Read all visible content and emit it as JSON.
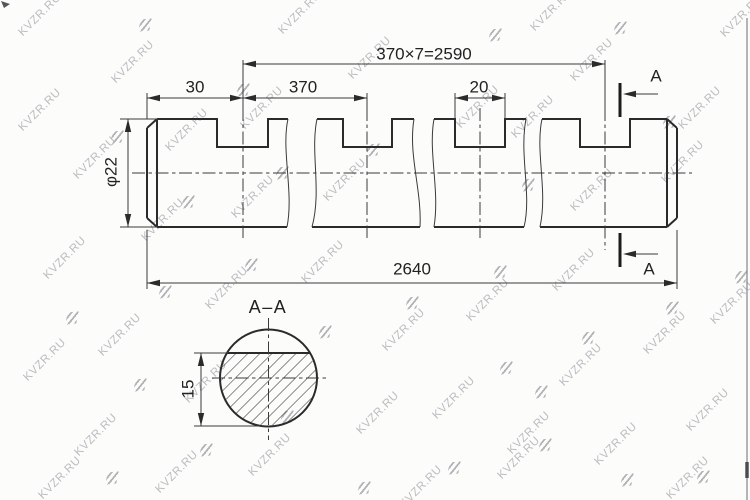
{
  "page": {
    "background": "#fcfcfb",
    "line_color": "#2b2b2b",
    "frame_edge_color": "#8d8d94"
  },
  "labels": {
    "dim_total_pattern": "370×7=2590",
    "dim_end_offset": "30",
    "dim_pitch": "370",
    "dim_slot_width": "20",
    "dim_diameter": "φ22",
    "dim_overall_length": "2640",
    "section_letter_top": "A",
    "section_letter_bottom": "A",
    "section_title": "A–A",
    "dim_section_height": "15"
  },
  "watermark": {
    "text": "KVZR.RU",
    "text_color": "#bcbcc1",
    "logo_color": "#b2b2b7",
    "text_positions": [
      [
        40,
        15
      ],
      [
        300,
        13
      ],
      [
        552,
        10
      ],
      [
        742,
        16
      ],
      [
        133,
        62
      ],
      [
        370,
        58
      ],
      [
        592,
        60
      ],
      [
        40,
        110
      ],
      [
        262,
        108
      ],
      [
        478,
        107
      ],
      [
        700,
        108
      ],
      [
        187,
        130
      ],
      [
        533,
        117
      ],
      [
        95,
        158
      ],
      [
        345,
        180
      ],
      [
        683,
        162
      ],
      [
        163,
        220
      ],
      [
        253,
        197
      ],
      [
        592,
        190
      ],
      [
        65,
        258
      ],
      [
        323,
        262
      ],
      [
        574,
        270
      ],
      [
        732,
        303
      ],
      [
        227,
        288
      ],
      [
        488,
        300
      ],
      [
        120,
        335
      ],
      [
        404,
        330
      ],
      [
        665,
        333
      ],
      [
        45,
        360
      ],
      [
        581,
        365
      ],
      [
        206,
        382
      ],
      [
        378,
        413
      ],
      [
        454,
        398
      ],
      [
        708,
        410
      ],
      [
        96,
        435
      ],
      [
        270,
        455
      ],
      [
        529,
        433
      ],
      [
        616,
        444
      ],
      [
        60,
        478
      ],
      [
        177,
        472
      ],
      [
        421,
        487
      ],
      [
        519,
        458
      ],
      [
        688,
        478
      ]
    ],
    "logo_positions": [
      [
        145,
        25
      ],
      [
        495,
        35
      ],
      [
        620,
        28
      ],
      [
        243,
        90
      ],
      [
        117,
        137
      ],
      [
        373,
        150
      ],
      [
        669,
        122
      ],
      [
        282,
        173
      ],
      [
        188,
        202
      ],
      [
        528,
        185
      ],
      [
        251,
        265
      ],
      [
        165,
        292
      ],
      [
        72,
        318
      ],
      [
        325,
        332
      ],
      [
        412,
        303
      ],
      [
        500,
        272
      ],
      [
        741,
        277
      ],
      [
        140,
        385
      ],
      [
        506,
        368
      ],
      [
        588,
        338
      ],
      [
        672,
        308
      ],
      [
        541,
        392
      ],
      [
        206,
        450
      ],
      [
        287,
        417
      ],
      [
        112,
        478
      ],
      [
        454,
        468
      ],
      [
        545,
        445
      ],
      [
        364,
        488
      ],
      [
        703,
        477
      ],
      [
        627,
        480
      ]
    ]
  }
}
